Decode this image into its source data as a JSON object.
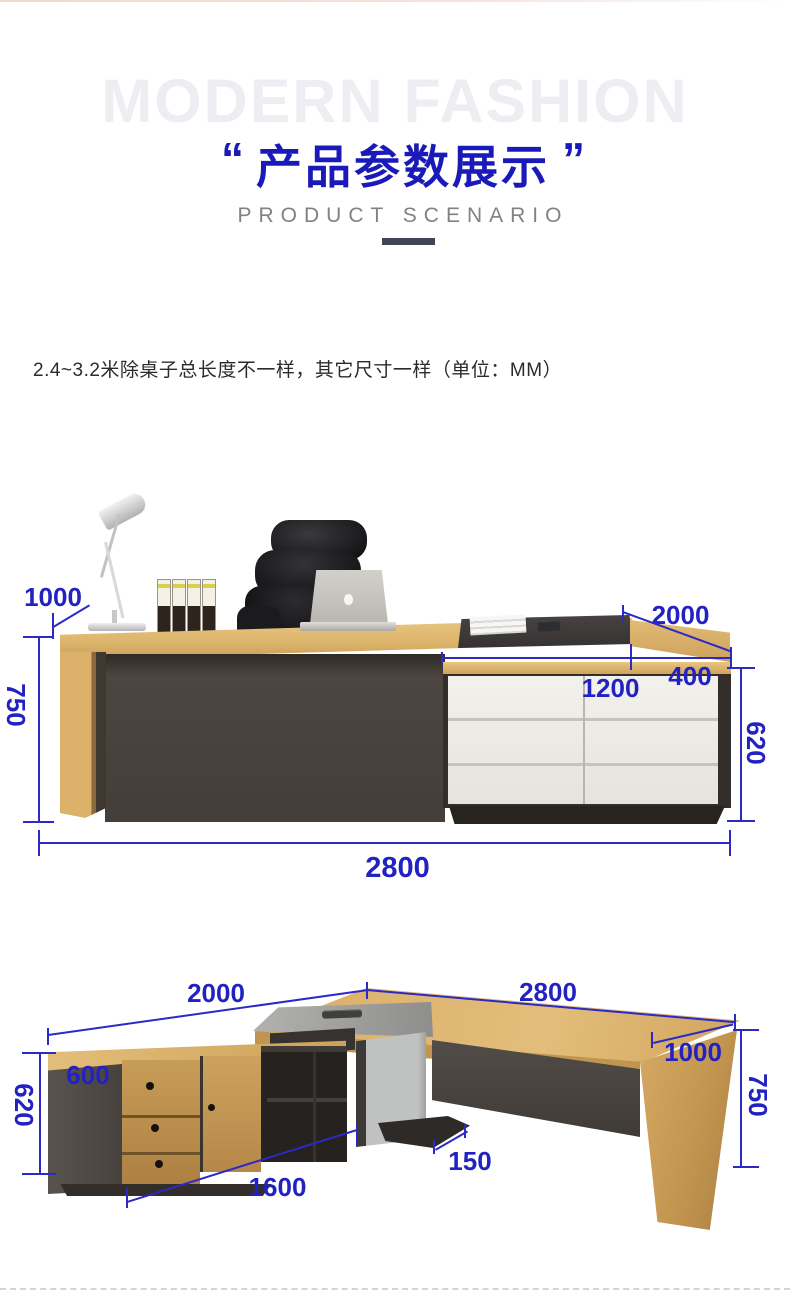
{
  "header": {
    "watermark": "MODERN FASHION",
    "quote_open": "“",
    "quote_close": "”",
    "title": "产品参数展示",
    "subtitle": "PRODUCT SCENARIO"
  },
  "note": "2.4~3.2米除桌子总长度不一样，其它尺寸一样（单位：MM）",
  "colors": {
    "dimension_blue": "#2222c2",
    "title_blue": "#1a1ab8",
    "wood": "#d8ad66",
    "dark_panel": "#4b433e",
    "drawer_white": "#f0ede7",
    "divider_bar": "#3f4552"
  },
  "diagram1": {
    "left_depth": "1000",
    "desk_height": "750",
    "return_length": "2000",
    "top_inset": "400",
    "cabinet_length": "1200",
    "cabinet_height": "620",
    "total_length": "2800"
  },
  "diagram2": {
    "return_length": "2000",
    "main_length": "2800",
    "cabinet_depth": "600",
    "cabinet_height": "620",
    "main_depth": "1000",
    "desk_height": "750",
    "panel_thickness": "150",
    "cabinet_length": "1600"
  }
}
